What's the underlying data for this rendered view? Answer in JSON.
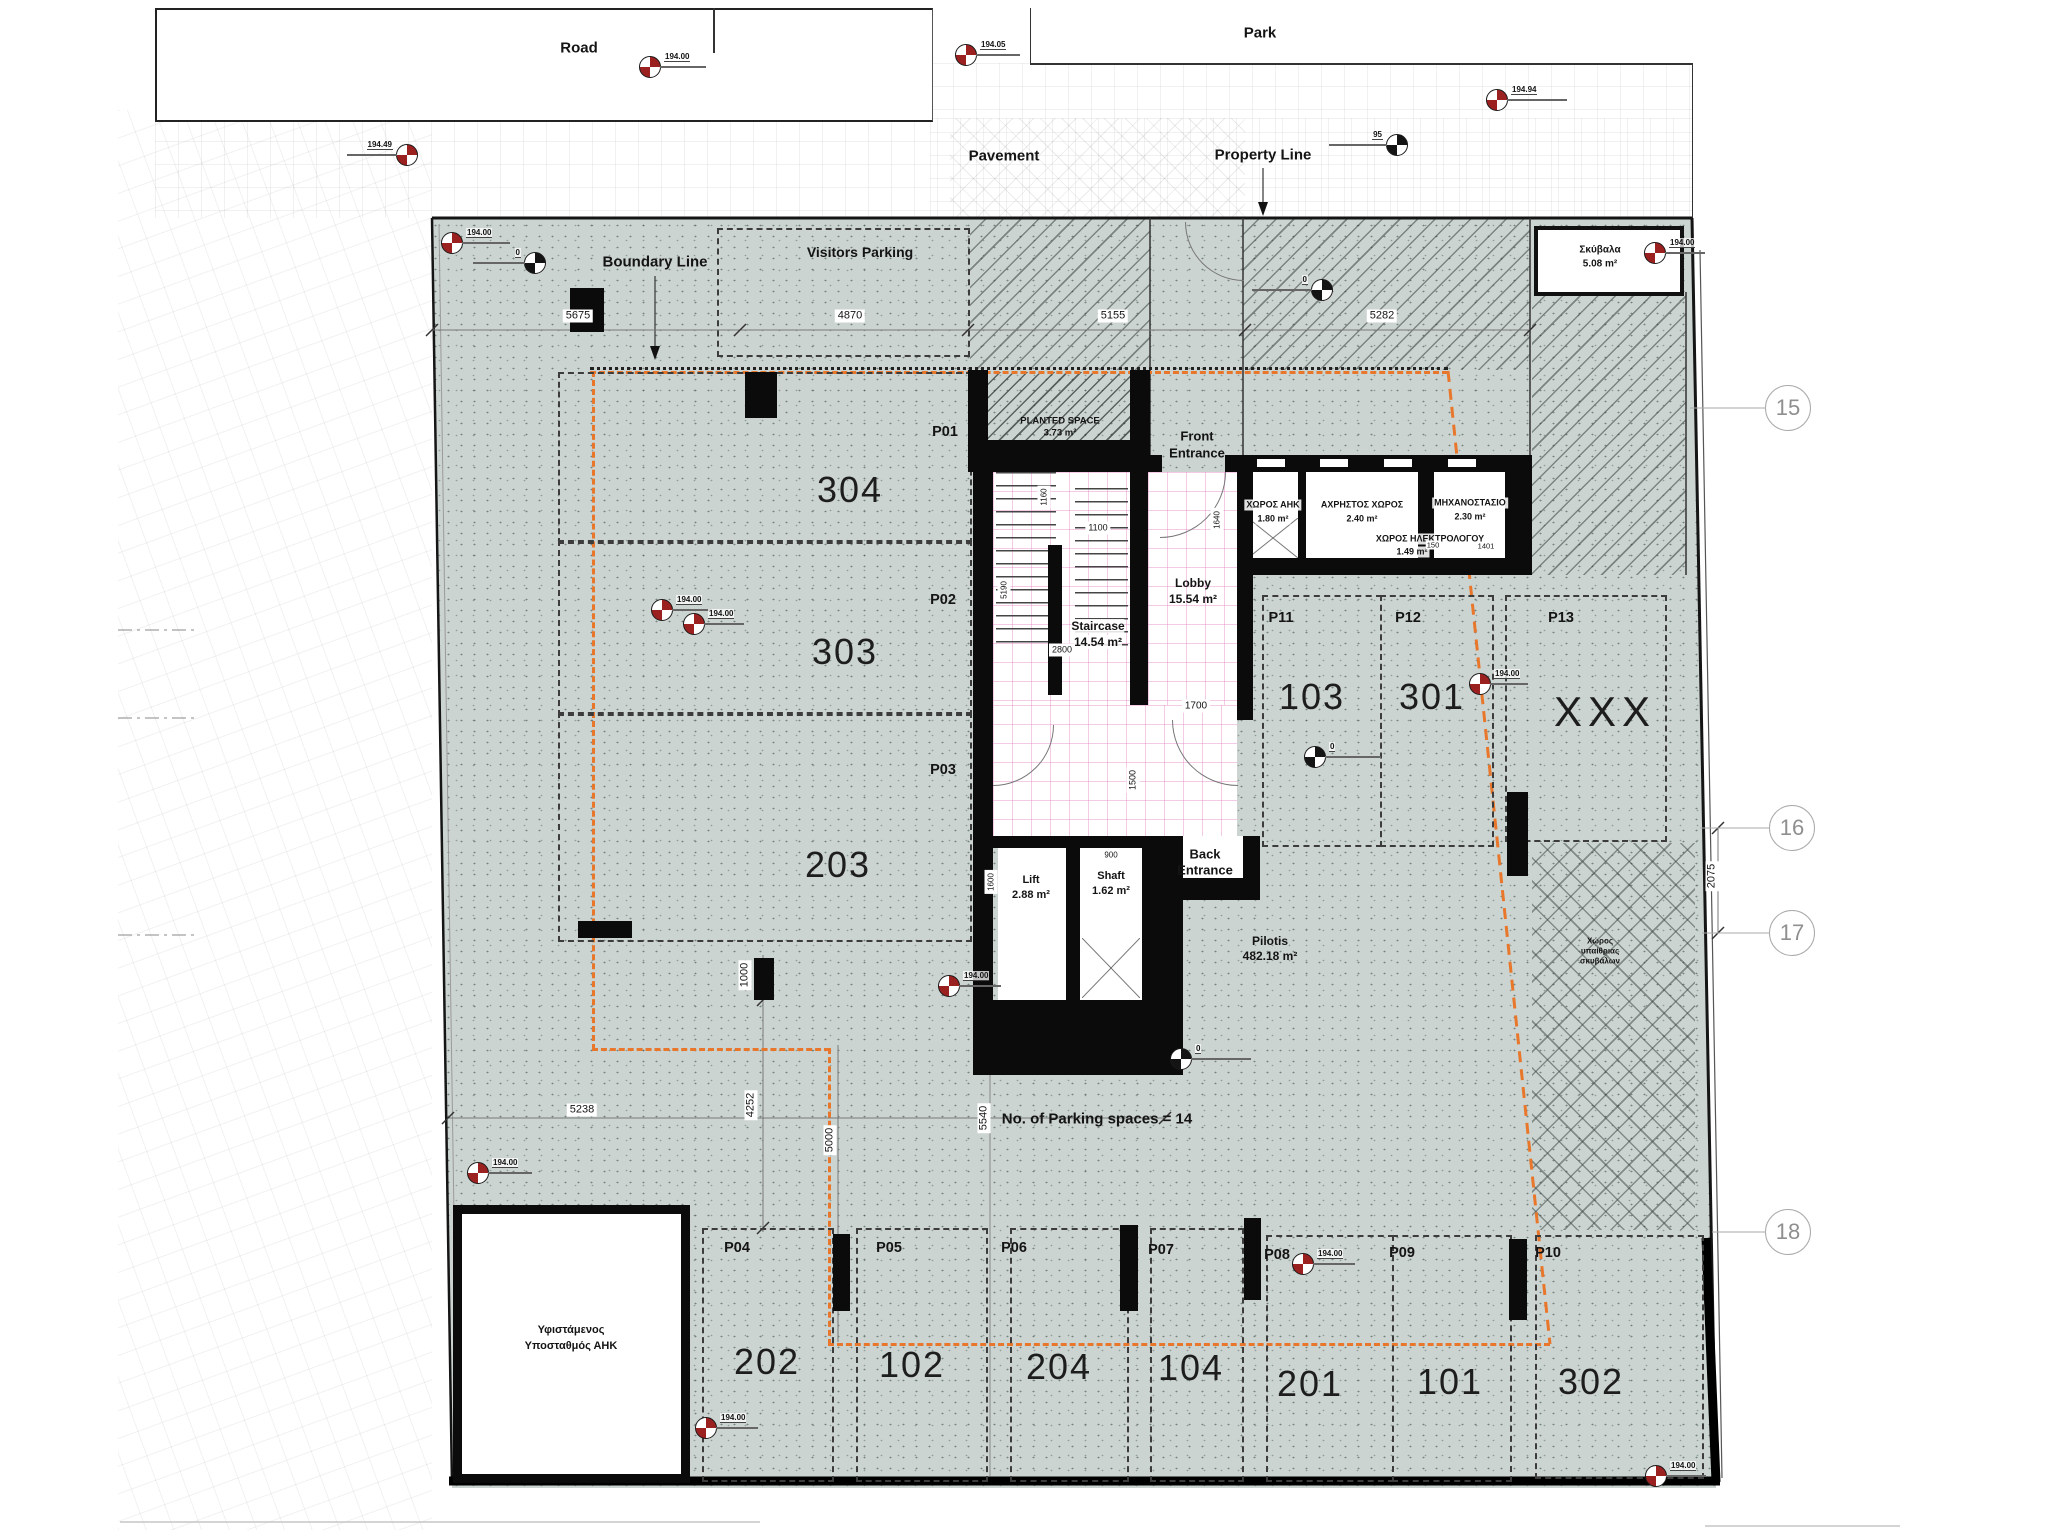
{
  "surroundings": {
    "road": "Road",
    "park": "Park",
    "pavement": "Pavement",
    "property_line": "Property Line",
    "boundary_line": "Boundary Line"
  },
  "site": {
    "visitors_parking": "Visitors Parking",
    "parking_note": "No. of Parking spaces = 14",
    "pilotis_l1": "Pilotis",
    "pilotis_l2": "482.18 m²"
  },
  "rooms": {
    "planted_l1": "PLANTED SPACE",
    "planted_l2": "3.73 m²",
    "front_l1": "Front",
    "front_l2": "Entrance",
    "back_l1": "Back",
    "back_l2": "Entrance",
    "lobby_l1": "Lobby",
    "lobby_l2": "15.54 m²",
    "stair_l1": "Staircase",
    "stair_l2": "14.54 m²",
    "lift_l1": "Lift",
    "lift_l2": "2.88 m²",
    "shaft_l1": "Shaft",
    "shaft_l2": "1.62 m²",
    "ahk_l1": "ΧΩΡΟΣ ΑΗΚ",
    "ahk_l2": "1.80 m²",
    "axristos_l1": "ΑΧΡΗΣΤΟΣ ΧΩΡΟΣ",
    "axristos_l2": "2.40 m²",
    "mixano_l1": "ΜΗΧΑΝΟΣΤΑΣΙΟ",
    "mixano_l2": "2.30 m²",
    "ilektro_l1": "ΧΩΡΟΣ ΗΛΕΚΤΡΟΛΟΓΟΥ",
    "ilektro_l2": "1.49 m²",
    "skyvala_l1": "Σκύβαλα",
    "skyvala_l2": "5.08 m²",
    "substation_l1": "Υφιστάμενος",
    "substation_l2": "Υποσταθμός ΑΗΚ",
    "storage_l1": "Χώρος",
    "storage_l2": "υπαίθριας",
    "storage_l3": "σκυβάλων",
    "xxx": "XXX"
  },
  "parking": {
    "p01": "P01",
    "p02": "P02",
    "p03": "P03",
    "p04": "P04",
    "p05": "P05",
    "p06": "P06",
    "p07": "P07",
    "p08": "P08",
    "p09": "P09",
    "p10": "P10",
    "p11": "P11",
    "p12": "P12",
    "p13": "P13",
    "u304": "304",
    "u303": "303",
    "u203": "203",
    "u202": "202",
    "u102": "102",
    "u204": "204",
    "u104": "104",
    "u201": "201",
    "u101": "101",
    "u302": "302",
    "u103": "103",
    "u301": "301"
  },
  "grid": {
    "g15": "15",
    "g16": "16",
    "g17": "17",
    "g18": "18"
  },
  "dims": {
    "d5675": "5675",
    "d4870": "4870",
    "d5155": "5155",
    "d5282": "5282",
    "d2075": "2075",
    "d5238": "5238",
    "d1000": "1000",
    "d4252": "4252",
    "d5000": "5000",
    "d5540": "5540",
    "d1100": "1100",
    "d2800": "2800",
    "d1700": "1700",
    "d1500": "1500",
    "d900": "900",
    "d1160": "1160",
    "d5190": "5190",
    "d1600": "1600",
    "d1640": "1640",
    "d150": "150",
    "d1401": "1401"
  },
  "markers": {
    "e19400": "194.00",
    "e19405": "194.05",
    "e19449": "194.49",
    "e19494": "194.94",
    "zero": "0",
    "b95": "95"
  },
  "colors": {
    "orange": "#e8772b",
    "marker_red": "#9b2020",
    "site_fill": "#ccd4d1"
  }
}
